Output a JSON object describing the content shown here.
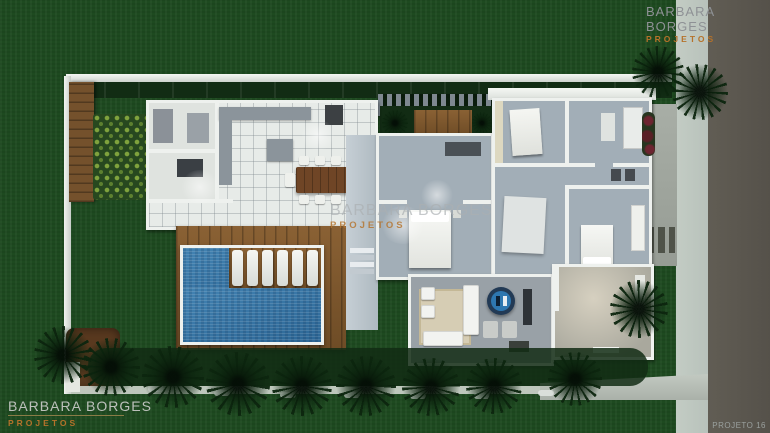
{
  "branding": {
    "company": "BARBARA BORGES",
    "division": "PROJETOS"
  },
  "watermarks": {
    "top_right": {
      "line1": "BARBARA BORGES",
      "line2": "PROJETOS"
    },
    "center": {
      "line1": "BARBARA BORGES",
      "line2": "PROJETOS"
    },
    "bottom_left": {
      "line1": "BARBARA BORGES",
      "line2": "PROJETOS"
    },
    "project_label": "PROJETO 16"
  },
  "colors": {
    "lawn": "#1e4a20",
    "hedge": "#122c14",
    "road": "#55514a",
    "sidewalk": "#b8c2bb",
    "pool-water": "#4383b2",
    "pool-deep": "#2d6796",
    "deck-wood": "#8a6134",
    "deck-wood-dark": "#6e4c26",
    "gate-wood": "#74512c",
    "wall-white": "#eef1ee",
    "floor-tile": "#e7ebe8",
    "floor-gray": "#a2aeb7",
    "floor-warm": "#cfc9b9",
    "counter-gray": "#8b949b",
    "furniture-white": "#f2f3f0",
    "table-wood": "#6f4526",
    "rug-beige": "#d6cdb4",
    "accent-orange": "#b5722a",
    "text-gray": "#8e9195",
    "text-light": "#bcc0bb",
    "soil": "#59391f",
    "plant-light": "#7fa23d",
    "underline-olive": "#8a7c46"
  }
}
